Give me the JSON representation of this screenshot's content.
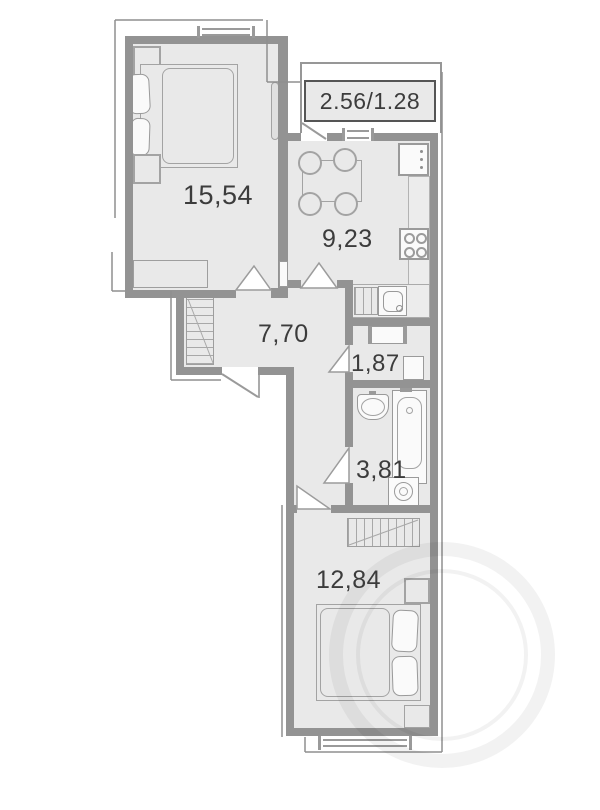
{
  "plan": {
    "type": "apartment-floor-plan",
    "balcony_label": "2.56/1.28",
    "rooms": {
      "bedroom": {
        "name": "bedroom",
        "area_label": "15,54"
      },
      "kitchen": {
        "name": "kitchen",
        "area_label": "9,23"
      },
      "hallway": {
        "name": "hallway",
        "area_label": "7,70"
      },
      "storage": {
        "name": "storage",
        "area_label": "1,87"
      },
      "bathroom": {
        "name": "bathroom",
        "area_label": "3,81"
      },
      "bedroom2": {
        "name": "bedroom-2",
        "area_label": "12,84"
      }
    },
    "colors": {
      "background": "#ffffff",
      "room_fill": "#e9e9e9",
      "wall": "#939393",
      "furniture_line": "#a3a3a3",
      "label_text": "#3c3c3c",
      "balcony_box_border": "#555555"
    },
    "furniture_icons": [
      "double-bed",
      "pillow",
      "nightstand",
      "bench",
      "radiator",
      "wardrobe",
      "dining-table",
      "chair",
      "fridge",
      "kitchen-counter",
      "stove",
      "kitchen-sink",
      "cabinet",
      "washbasin",
      "bathtub",
      "washing-machine",
      "window",
      "door-swing",
      "single-bed",
      "vent-shaft"
    ]
  }
}
